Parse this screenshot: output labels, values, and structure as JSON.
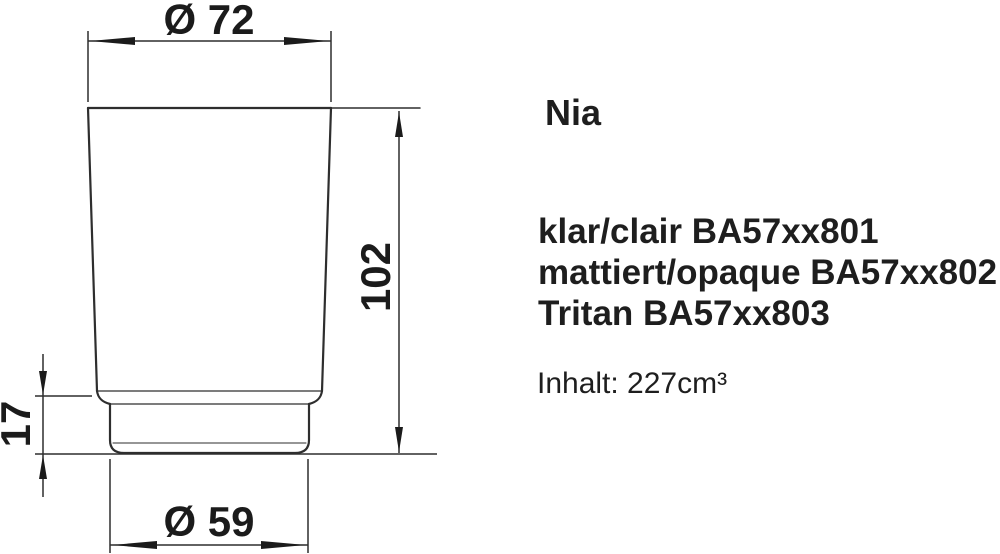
{
  "product": {
    "name": "Nia",
    "variants": [
      "klar/clair BA57xx801",
      "mattiert/opaque BA57xx802",
      "Tritan BA57xx803"
    ],
    "volume": "Inhalt: 227cm³"
  },
  "dimensions": {
    "top_diameter": "Ø 72",
    "height": "102",
    "base_height": "17",
    "base_diameter": "Ø 59"
  },
  "colors": {
    "background": "#ffffff",
    "outline": "#2e2e2e",
    "dimension_line": "#2e2e2e",
    "text": "#1e1e1e",
    "label": "#1b1b1b"
  }
}
